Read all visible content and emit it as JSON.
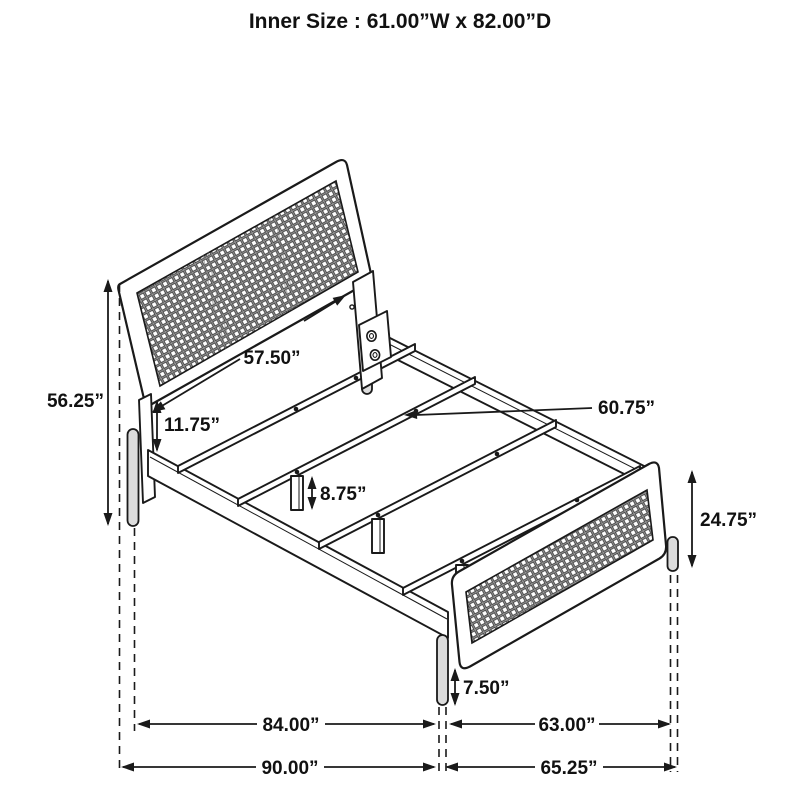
{
  "header": {
    "title": "Inner Size : 61.00”W x 82.00”D"
  },
  "diagram": {
    "description": "Isometric black-and-white line drawing of a bed frame with woven cane headboard and footboard panels, slat supports and dimension callouts",
    "colors": {
      "line": "#1a1a1a",
      "background": "#ffffff",
      "leg_fill": "#dcdcdc",
      "mesh_tone": "#9a9a9a"
    },
    "dimensions": {
      "inner_width": "61.00”W",
      "inner_depth": "82.00”D",
      "headboard_width": "57.50”",
      "headboard_height": "56.25”",
      "headboard_clearance": "11.75”",
      "slat_length": "60.75”",
      "center_leg_height": "8.75”",
      "footboard_height": "24.75”",
      "footboard_leg_height": "7.50”",
      "side_rail_length": "84.00”",
      "footboard_inner_span": "63.00”",
      "overall_depth": "90.00”",
      "overall_width": "65.25”"
    }
  }
}
